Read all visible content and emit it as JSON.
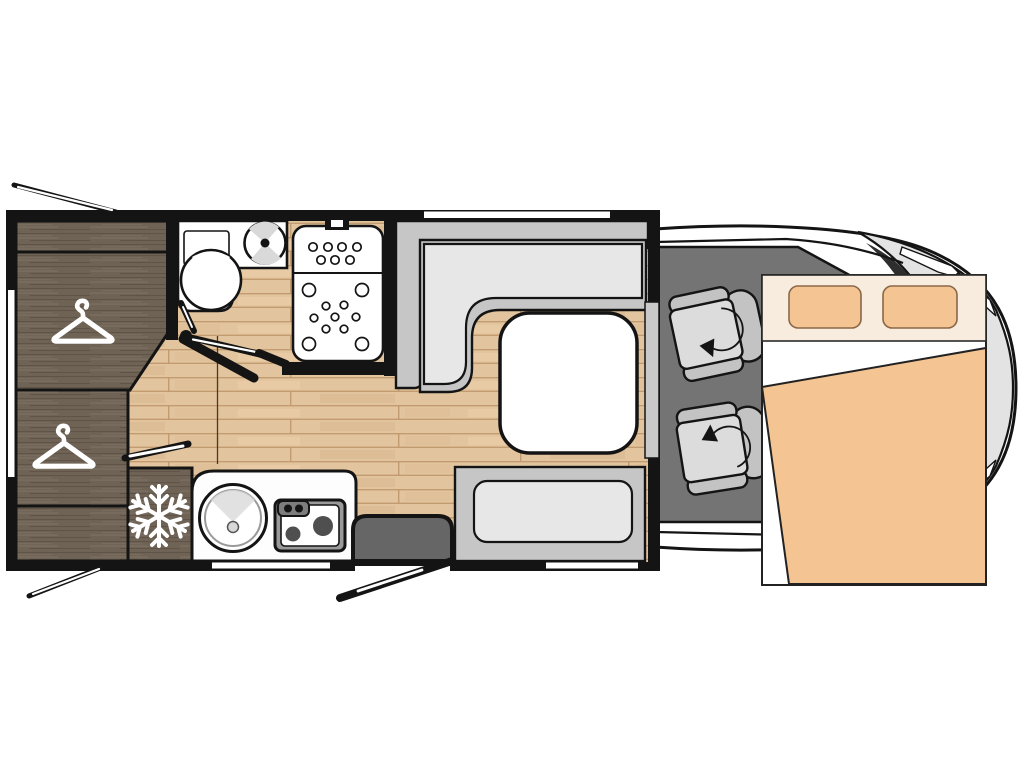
{
  "diagram": {
    "type": "motorhome-floor-plan-top-view",
    "orientation": "vehicle front on the right, habitation area on the left",
    "areas": [
      "wardrobe-cabinets",
      "hanging-wardrobe-upper",
      "hanging-wardrobe-lower",
      "fridge",
      "bathroom",
      "toilet",
      "washbasin",
      "shower-tray",
      "kitchen-counter",
      "round-sink",
      "two-burner-hob",
      "entry-step",
      "entry-door",
      "side-bench-seat",
      "l-shaped-dinette-seat",
      "dinette-table",
      "cab-swivel-seat-driver",
      "cab-swivel-seat-passenger",
      "drop-down-double-bed",
      "vehicle-cab-front"
    ],
    "icons": [
      {
        "name": "hanger-icon",
        "meaning": "hanging wardrobe",
        "count": 2
      },
      {
        "name": "snowflake-icon",
        "meaning": "refrigerator",
        "count": 1
      },
      {
        "name": "rotation-arrow-icon",
        "meaning": "swivelling cab seat",
        "count": 2
      }
    ]
  },
  "colors": {
    "background": "#ffffff",
    "wall": "#141414",
    "floor-wood": "#e2c49e",
    "floor-plank": "#bd9468",
    "floor-streak": "#d9b88f",
    "floor-streak-light": "#eccfa9",
    "dark-wood": "#6f6355",
    "dark-wood-hi": "#7e7264",
    "dark-wood-lo": "#5f5447",
    "white": "#ffffff",
    "counter": "#fdfdfd",
    "sofa-base": "#c6c6c6",
    "sofa-cushion": "#e7e7e7",
    "cab-floor": "#747474",
    "seat": "#dcdcdc",
    "seat-dark": "#c3c3c3",
    "body-gray": "#e3e3e3",
    "windshield": "#2e2e2e",
    "bed-cream": "#f8ecdf",
    "bed-peach": "#f4c492",
    "pillow-stroke": "#8a6848",
    "step": "#666666",
    "trim": "#c9c9c9",
    "shade": "#d9d9d9"
  }
}
